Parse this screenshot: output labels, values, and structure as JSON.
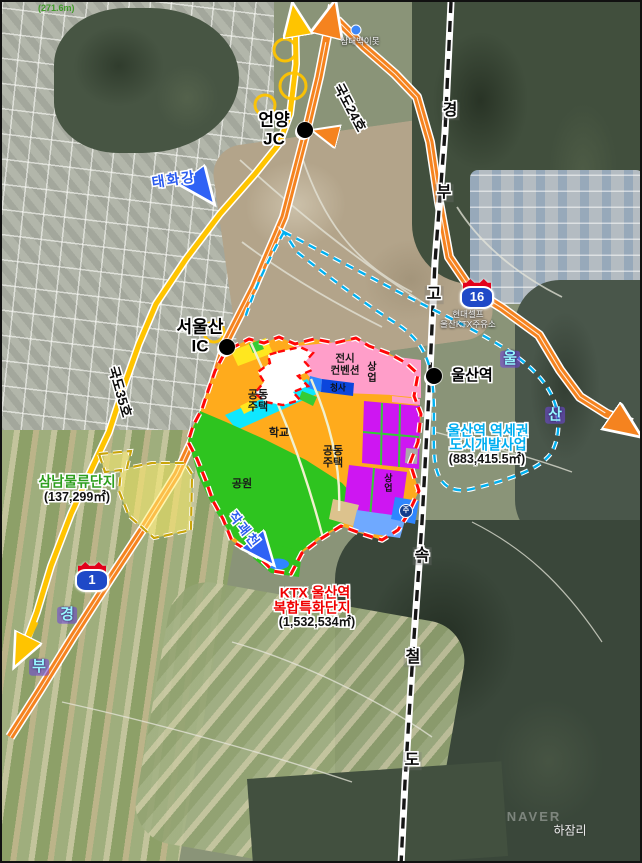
{
  "map_colors": {
    "expressway_orange": "#f5831f",
    "national_road_yellow": "#ffc400",
    "railway_black": "#151515",
    "ktx_zone_red": "#ff0808",
    "station_zone_cyan": "#00b0f0",
    "samnam_dash_olive": "#c9a50a",
    "river_blue": "#2f62f5"
  },
  "road_labels": {
    "route24": "국도24호",
    "route35": "국도35호"
  },
  "shields": {
    "expwy16": "16",
    "expwy1": "1"
  },
  "corridor_letters": {
    "rail": [
      "경",
      "부",
      "고",
      "속",
      "철",
      "도"
    ],
    "gyeongbu_expwy": [
      "경",
      "부"
    ],
    "ulsan_expwy": [
      "울",
      "산"
    ]
  },
  "stations": {
    "eonyang": {
      "name": "언양",
      "suffix": "JC"
    },
    "seoulsan": {
      "name": "서울산",
      "suffix": "IC"
    },
    "ulsan": {
      "name": "울산역"
    }
  },
  "rivers": {
    "taehwagang": "태화강",
    "jakgwaecheon": "작괘천"
  },
  "zones": {
    "ktx_complex": {
      "line1": "KTX 울산역",
      "line2": "복합특화단지",
      "area": "(1,532,534㎡)"
    },
    "station_district": {
      "line1": "울산역 역세권",
      "line2": "도시개발사업",
      "area": "(883,415.5㎡)"
    },
    "samnam_logistics": {
      "name": "삼남물류단지",
      "area": "(137,299㎡)"
    }
  },
  "parcels": {
    "apt_left_1": "공동",
    "apt_left_2": "주택",
    "school": "학교",
    "park": "공원",
    "convention_1": "전시",
    "convention_2": "컨벤션",
    "commercial_top": "상업",
    "commercial_mid": "상업",
    "gov_office": "청사",
    "apt_center_1": "공동",
    "apt_center_2": "주택",
    "parking": "주"
  },
  "base_labels": {
    "elevation": "(271.6m)",
    "pond": "삼대백이못",
    "gas_station_1": "현대셀프",
    "gas_station_2": "울산KTX주유소",
    "village": "하잠리",
    "watermark": "NAVER"
  }
}
